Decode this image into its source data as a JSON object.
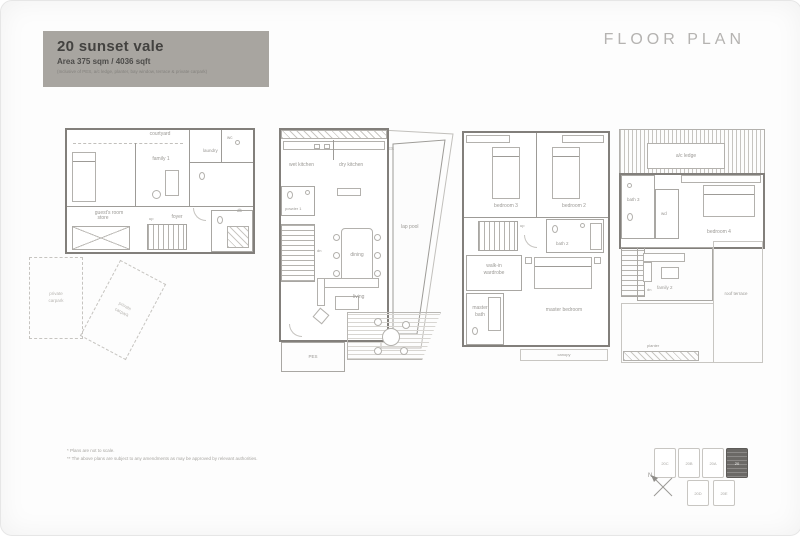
{
  "header": {
    "title": "20 sunset vale",
    "area": "Area 375 sqm / 4036 sqft",
    "note": "(Inclusive of PES, a/c ledge, planter, bay window, terrace & private carpark)"
  },
  "doc_title": "FLOOR PLAN",
  "footnotes": {
    "line1": "* Plans are not to scale.",
    "line2": "** The above plans are subject to any amendments as may be approved by relevant authorities."
  },
  "plan1": {
    "courtyard": "courtyard",
    "family": "family 1",
    "guest_room": "guest's room",
    "store": "store",
    "foyer": "foyer",
    "laundry": "laundry",
    "wc": "wc",
    "db": "db",
    "up": "up"
  },
  "carparks": {
    "a": "private carpark",
    "b": "private carpark"
  },
  "plan2": {
    "wet_kitchen": "wet kitchen",
    "dry_kitchen": "dry kitchen",
    "pes_top": "PES",
    "lap_pool": "lap pool",
    "powder": "powder 1",
    "dining": "dining",
    "living": "living",
    "pes_bottom": "PES",
    "dn": "dn"
  },
  "plan3": {
    "bedroom_left": "bedroom 3",
    "bedroom_right": "bedroom 2",
    "bath2": "bath 2",
    "walkin": "walk-in wardrobe",
    "master_bath": "master bath",
    "master_bedroom": "master bedroom",
    "canopy": "canopy",
    "up": "up"
  },
  "plan4": {
    "ac_ledge": "a/c ledge",
    "bath3": "bath 3",
    "wd": "wd",
    "bedroom4": "bedroom 4",
    "family2": "family 2",
    "roof_terrace": "roof terrace",
    "planter": "planter",
    "dn": "dn"
  },
  "keyplan": {
    "units_top": [
      "20C",
      "20B",
      "20A",
      "20"
    ],
    "units_bottom": [
      "20D",
      "20E"
    ],
    "north": "N"
  },
  "colors": {
    "band": "#a8a5a0",
    "highlight_unit": "#6b6966",
    "wall": "#827f7b"
  }
}
